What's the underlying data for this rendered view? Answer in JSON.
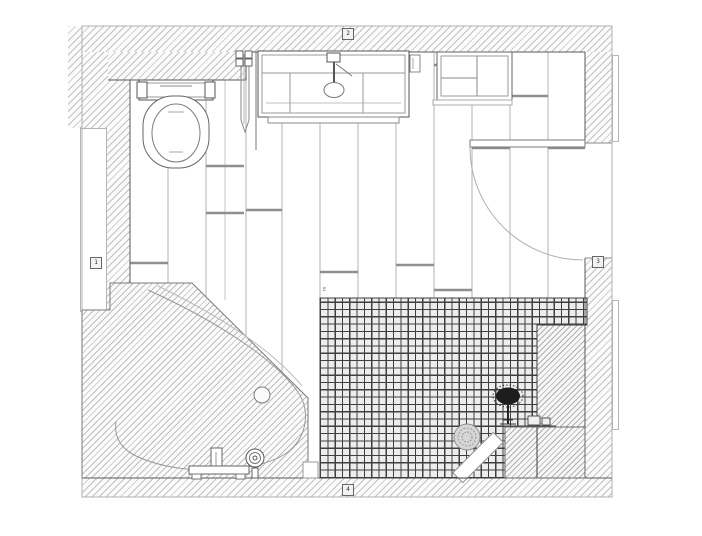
{
  "drawing": {
    "kind": "bathroom floor plan",
    "elevation_markers": [
      {
        "label": "1",
        "side": "left"
      },
      {
        "label": "2",
        "side": "top"
      },
      {
        "label": "3",
        "side": "right"
      },
      {
        "label": "4",
        "side": "bottom"
      }
    ],
    "annotations": {
      "shower_corner_label": "E"
    },
    "fixtures": [
      "toilet",
      "washbasin-vanity",
      "basin-faucet",
      "towel-rail",
      "window",
      "door-swing",
      "mosaic-shower-floor",
      "shower-bench",
      "plant-or-drain",
      "stone-drain",
      "bathtub-platform",
      "tub-faucet",
      "tub-knob",
      "step-ramp"
    ],
    "colors": {
      "background": "#ffffff",
      "wall_hatch": "#919191",
      "dark_line": "#555555",
      "light_line": "#aaaaaa",
      "mosaic_grid": "#3f3f3f",
      "fixture_dark": "#1d1d1d"
    }
  }
}
